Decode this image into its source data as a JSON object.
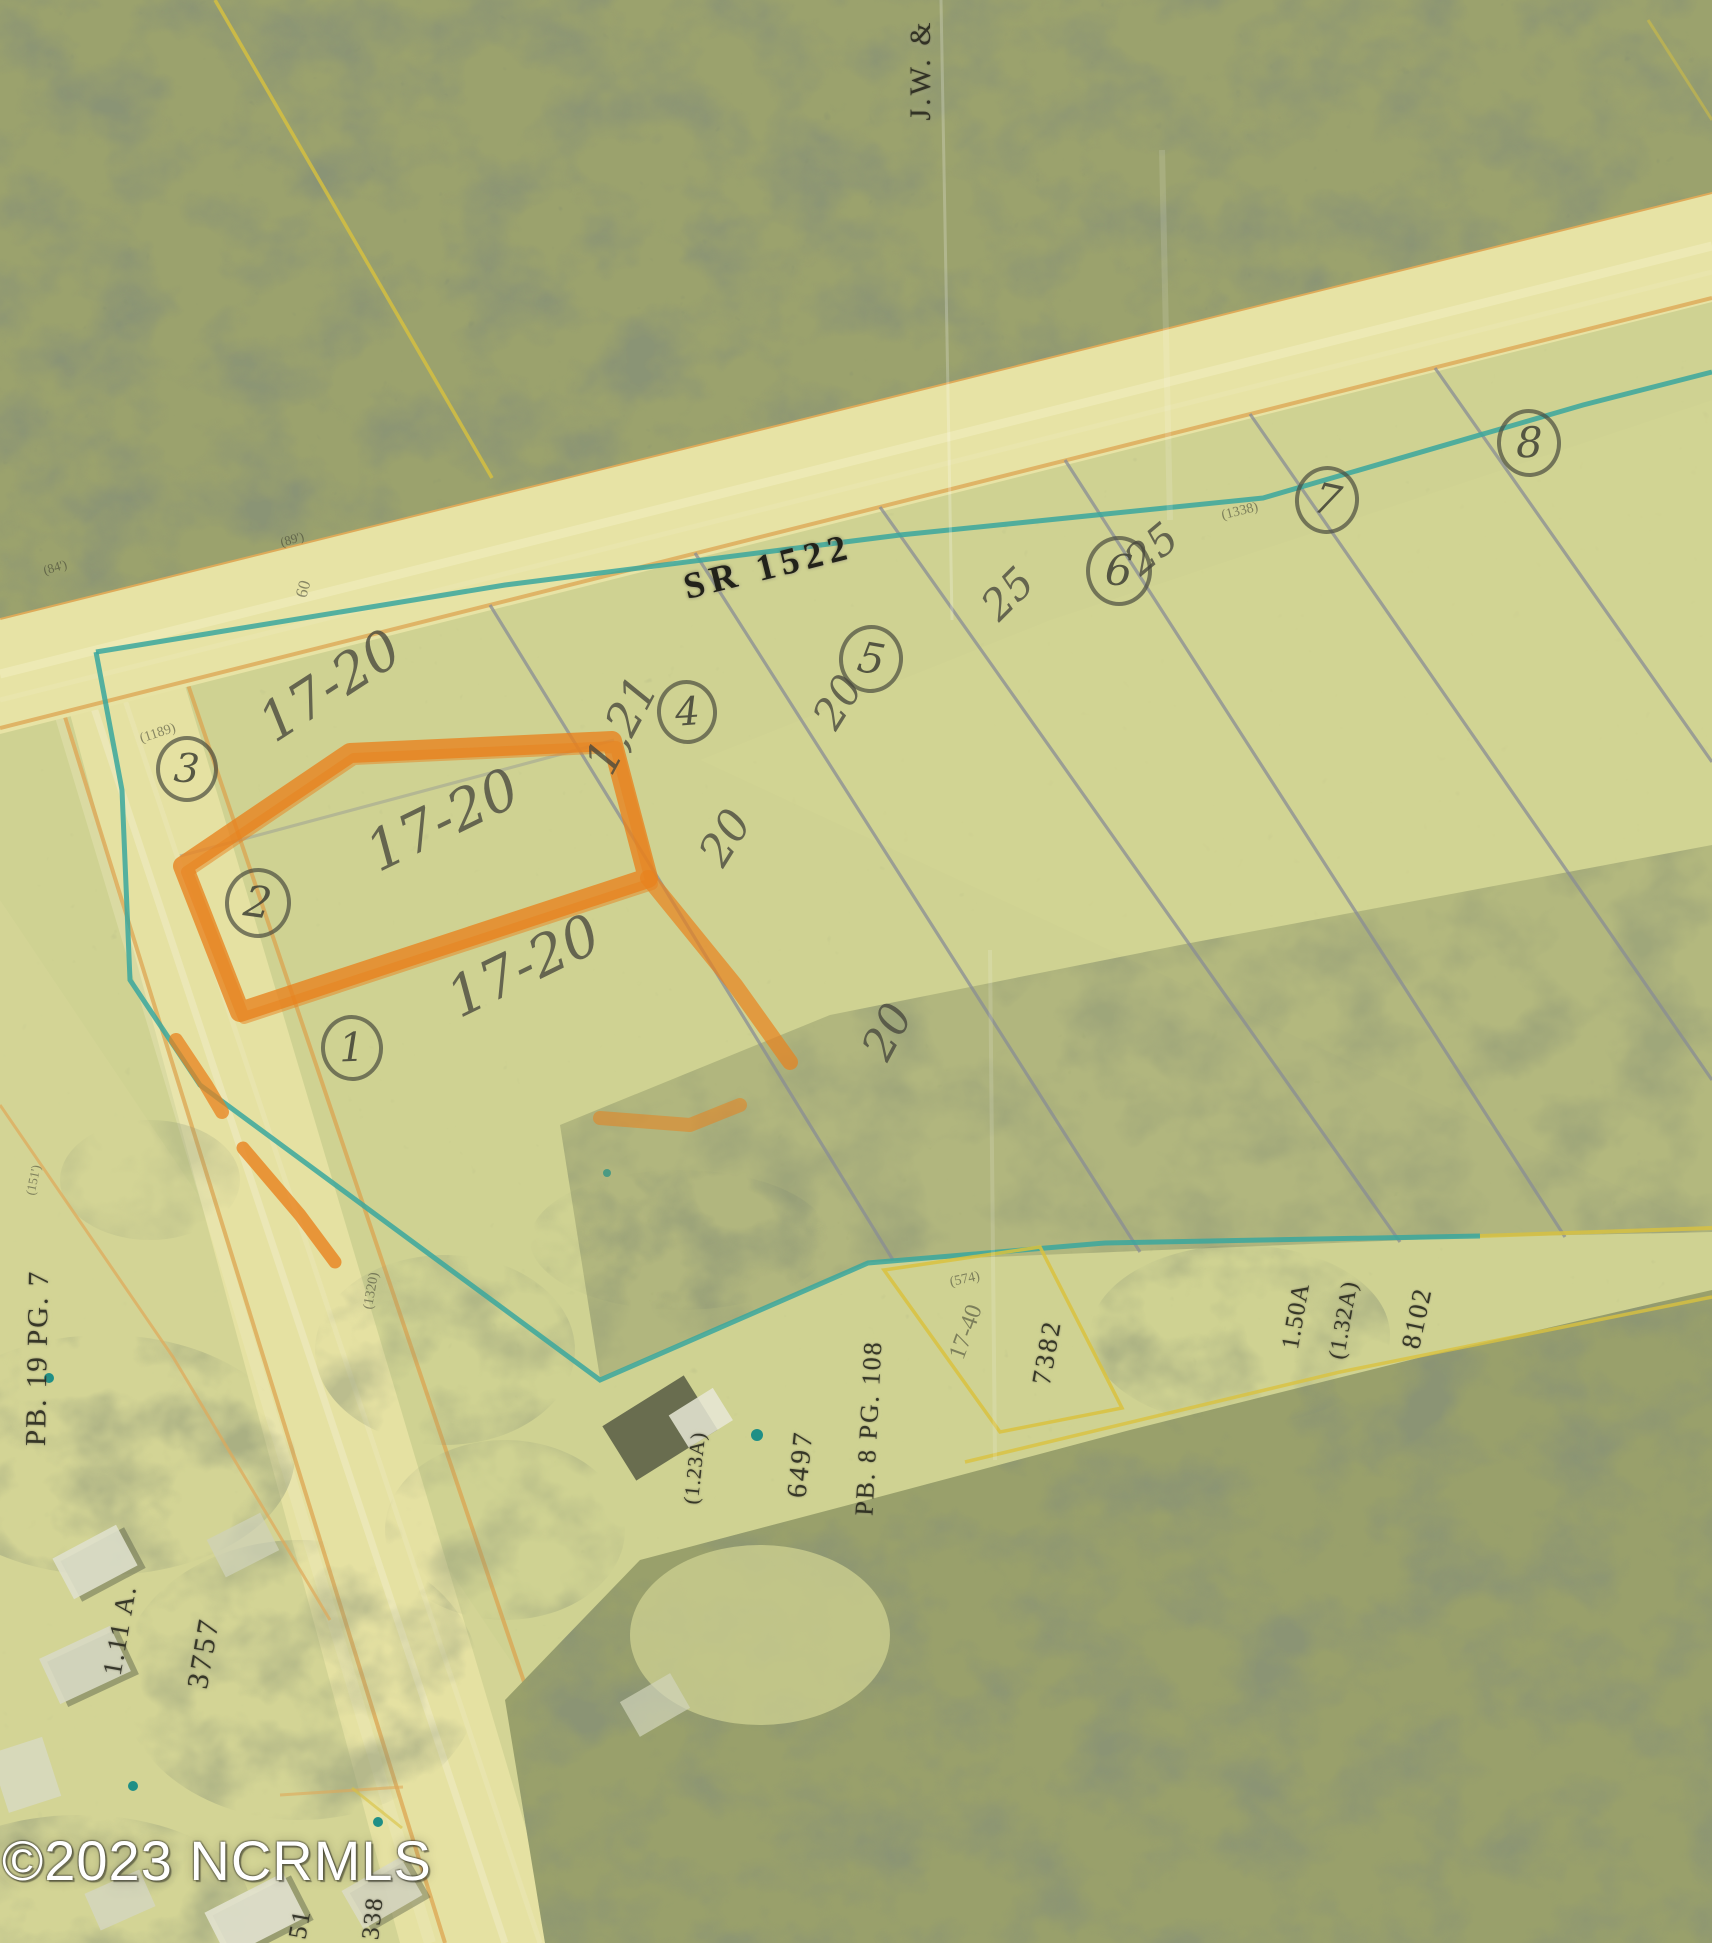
{
  "map": {
    "road": {
      "label": "SR 1522"
    },
    "watermark": {
      "text": "©2023 NCRMLS"
    },
    "colors": {
      "field": "#cfd292",
      "forest": "#9ba26d",
      "road_surface": "#e7e3a5",
      "road_edge": "#dda14c",
      "parcel_teal": "#3aa79e",
      "lot_line_gray": "#888c95",
      "parcel_yellow": "#d9c23e",
      "highlighter_orange": "#e8821e",
      "pencil": "#54554b",
      "printed_text": "#2a2a1f",
      "watermark_fill": "#ffffff"
    }
  },
  "lot_circles": [
    {
      "num": "1",
      "x": 352,
      "y": 1048,
      "r": 31,
      "rot": -6
    },
    {
      "num": "2",
      "x": 258,
      "y": 903,
      "r": 33,
      "rot": 4
    },
    {
      "num": "3",
      "x": 187,
      "y": 769,
      "r": 31,
      "rot": 0
    },
    {
      "num": "4",
      "x": 687,
      "y": 712,
      "r": 30,
      "rot": -8
    },
    {
      "num": "5",
      "x": 871,
      "y": 659,
      "r": 32,
      "rot": 6
    },
    {
      "num": "6",
      "x": 1119,
      "y": 571,
      "r": 33,
      "rot": 0
    },
    {
      "num": "7",
      "x": 1327,
      "y": 500,
      "r": 32,
      "rot": 8
    },
    {
      "num": "8",
      "x": 1529,
      "y": 443,
      "r": 32,
      "rot": -5
    }
  ],
  "hand_notes": [
    {
      "text": "17-20",
      "x": 330,
      "y": 686,
      "rot": -33,
      "size": 54
    },
    {
      "text": "17-20",
      "x": 443,
      "y": 821,
      "rot": -26,
      "size": 56
    },
    {
      "text": "17-20",
      "x": 524,
      "y": 967,
      "rot": -26,
      "size": 56
    },
    {
      "text": "1,21",
      "x": 621,
      "y": 725,
      "rot": -62,
      "size": 46
    },
    {
      "text": "20",
      "x": 726,
      "y": 838,
      "rot": -58,
      "size": 44
    },
    {
      "text": "20",
      "x": 838,
      "y": 702,
      "rot": -58,
      "size": 42
    },
    {
      "text": "20",
      "x": 888,
      "y": 1032,
      "rot": -62,
      "size": 44
    },
    {
      "text": "25",
      "x": 1008,
      "y": 594,
      "rot": -45,
      "size": 42
    },
    {
      "text": "25",
      "x": 1152,
      "y": 549,
      "rot": -40,
      "size": 42
    }
  ],
  "parcel_labels": [
    {
      "text": "J.W. &",
      "x": 921,
      "y": 70,
      "rot": -90,
      "size": 30,
      "ls": 3
    },
    {
      "text": "PB. 19 PG. 7",
      "x": 38,
      "y": 1358,
      "rot": -89,
      "size": 29,
      "ls": 2
    },
    {
      "text": "1.11 A.",
      "x": 120,
      "y": 1630,
      "rot": -80,
      "size": 27,
      "ls": 2
    },
    {
      "text": "3757",
      "x": 204,
      "y": 1653,
      "rot": -80,
      "size": 30,
      "ls": 3
    },
    {
      "text": "(1.23A)",
      "x": 695,
      "y": 1468,
      "rot": -84,
      "size": 21,
      "ls": 1
    },
    {
      "text": "6497",
      "x": 801,
      "y": 1464,
      "rot": -84,
      "size": 28,
      "ls": 3
    },
    {
      "text": "PB. 8 PG. 108",
      "x": 869,
      "y": 1428,
      "rot": -87,
      "size": 26,
      "ls": 2
    },
    {
      "text": "7382",
      "x": 1047,
      "y": 1352,
      "rot": -80,
      "size": 27,
      "ls": 3
    },
    {
      "text": "1.50A",
      "x": 1296,
      "y": 1316,
      "rot": -80,
      "size": 25,
      "ls": 1
    },
    {
      "text": "(1.32A)",
      "x": 1343,
      "y": 1320,
      "rot": -80,
      "size": 23,
      "ls": 1
    },
    {
      "text": "8102",
      "x": 1417,
      "y": 1318,
      "rot": -78,
      "size": 27,
      "ls": 2
    },
    {
      "text": "51",
      "x": 300,
      "y": 1924,
      "rot": -80,
      "size": 26,
      "ls": 2
    },
    {
      "text": "338",
      "x": 373,
      "y": 1918,
      "rot": -84,
      "size": 25,
      "ls": 2
    }
  ],
  "tiny_labels": [
    {
      "text": "(1189)",
      "x": 158,
      "y": 734,
      "rot": -18,
      "size": 14
    },
    {
      "text": "(84')",
      "x": 55,
      "y": 567,
      "rot": -16,
      "size": 13
    },
    {
      "text": "(89')",
      "x": 292,
      "y": 539,
      "rot": -16,
      "size": 13
    },
    {
      "text": "60",
      "x": 303,
      "y": 589,
      "rot": -75,
      "size": 17
    },
    {
      "text": "(1338)",
      "x": 1240,
      "y": 512,
      "rot": -14,
      "size": 14
    },
    {
      "text": "(1320)",
      "x": 372,
      "y": 1291,
      "rot": -80,
      "size": 14
    },
    {
      "text": "(151')",
      "x": 33,
      "y": 1180,
      "rot": -78,
      "size": 13
    },
    {
      "text": "(574)",
      "x": 965,
      "y": 1280,
      "rot": -12,
      "size": 14
    },
    {
      "text": "17-40",
      "x": 966,
      "y": 1332,
      "rot": -70,
      "size": 24
    }
  ]
}
